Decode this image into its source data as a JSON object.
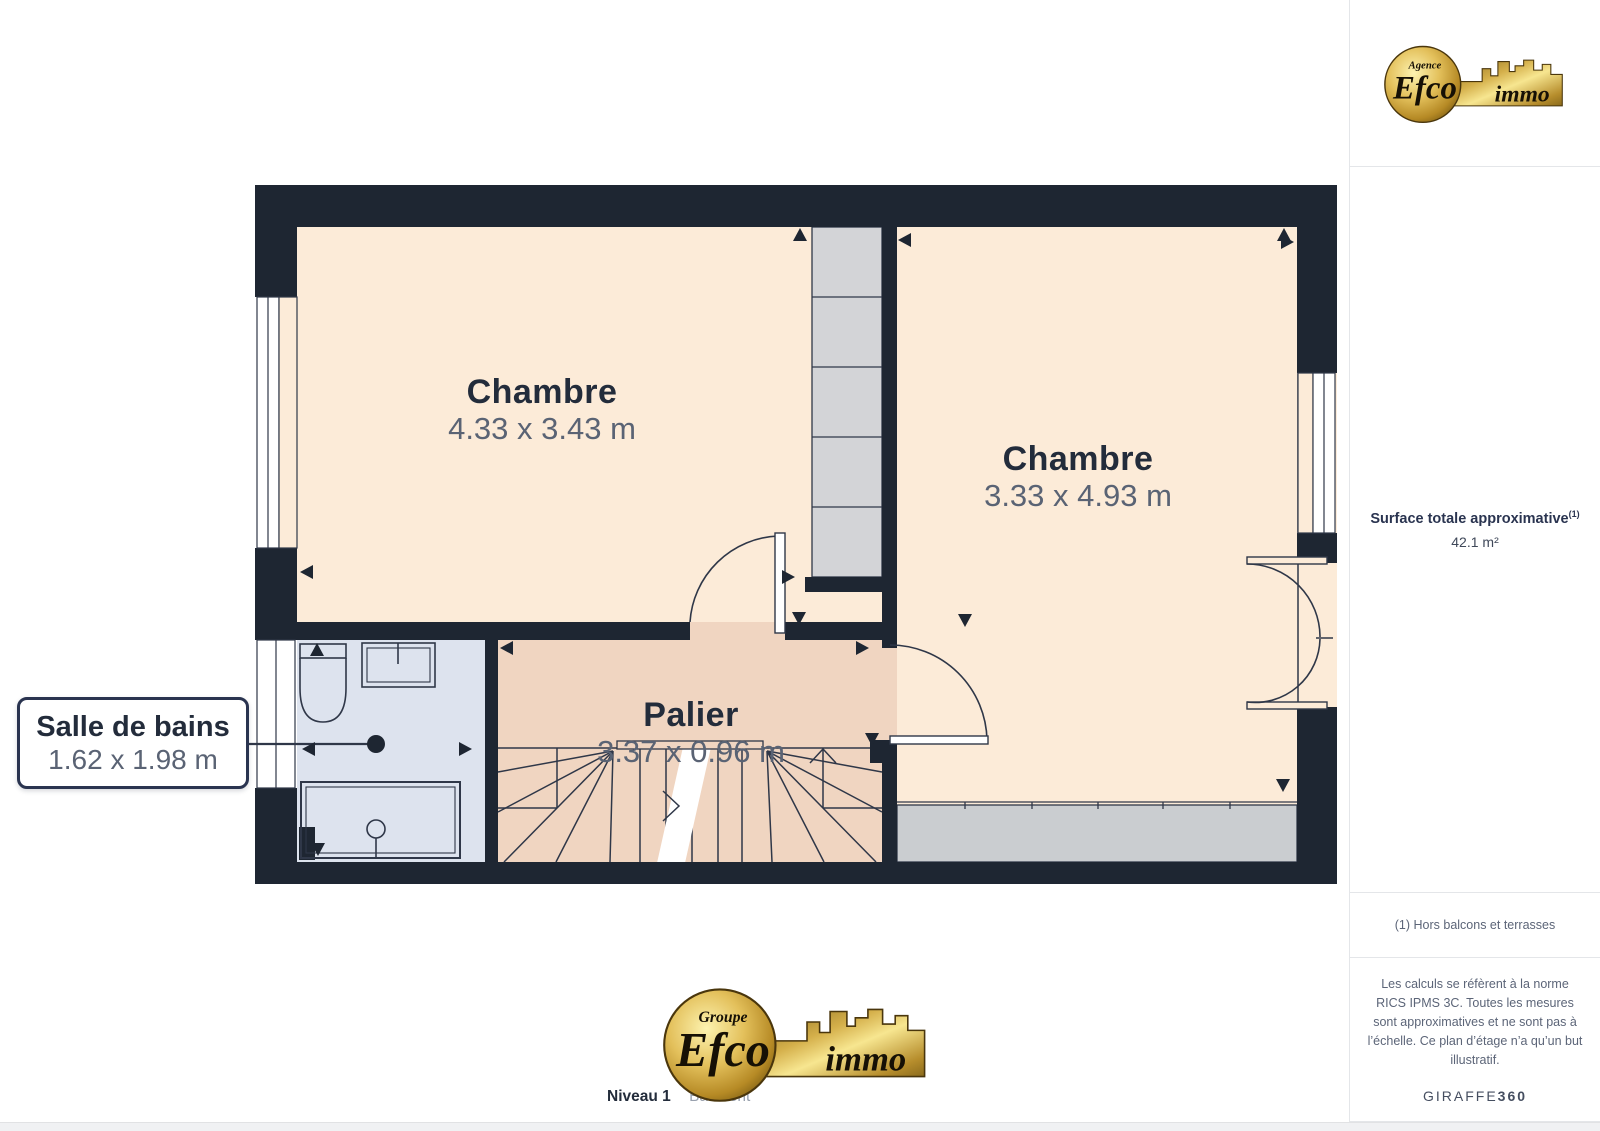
{
  "plan": {
    "rooms": [
      {
        "id": "bedroom-left",
        "name": "Chambre",
        "dims": "4.33 x 3.43 m"
      },
      {
        "id": "bedroom-right",
        "name": "Chambre",
        "dims": "3.33 x 4.93 m"
      },
      {
        "id": "landing",
        "name": "Palier",
        "dims": "3.37 x 0.96 m"
      },
      {
        "id": "bathroom",
        "name": "Salle de bains",
        "dims": "1.62 x 1.98 m"
      }
    ],
    "colors": {
      "wall": "#1e2632",
      "room_fill": "#fcebd8",
      "landing_fill": "#f0d5c1",
      "bathroom_fill": "#dde3ee",
      "closet_fill": "#d3d4d7",
      "wardrobe_fill": "#cacdd0",
      "line": "#2f3748",
      "label": "#232c3b",
      "dims_text": "#5a6374",
      "logo_gold": "#d4af4a"
    }
  },
  "sidebar": {
    "surface_label": "Surface totale approximative",
    "surface_note_ref": "(1)",
    "surface_value": "42.1 m²",
    "footnote": "(1) Hors balcons et terrasses",
    "disclaimer": "Les calculs se réfèrent à la norme RICS IPMS 3C. Toutes les mesures sont approximatives et ne sont pas à l’échelle. Ce plan d’étage n’a qu’un but illustratif.",
    "brand": "GIRAFFE",
    "brand_suffix": "360"
  },
  "footer": {
    "level_label": "Niveau 1",
    "building_label": "Bâtiment"
  },
  "logos": {
    "header": {
      "tagline": "Agence",
      "name": "Efco",
      "suffix": "immo"
    },
    "footer": {
      "tagline": "Groupe",
      "name": "Efco",
      "suffix": "immo"
    }
  }
}
